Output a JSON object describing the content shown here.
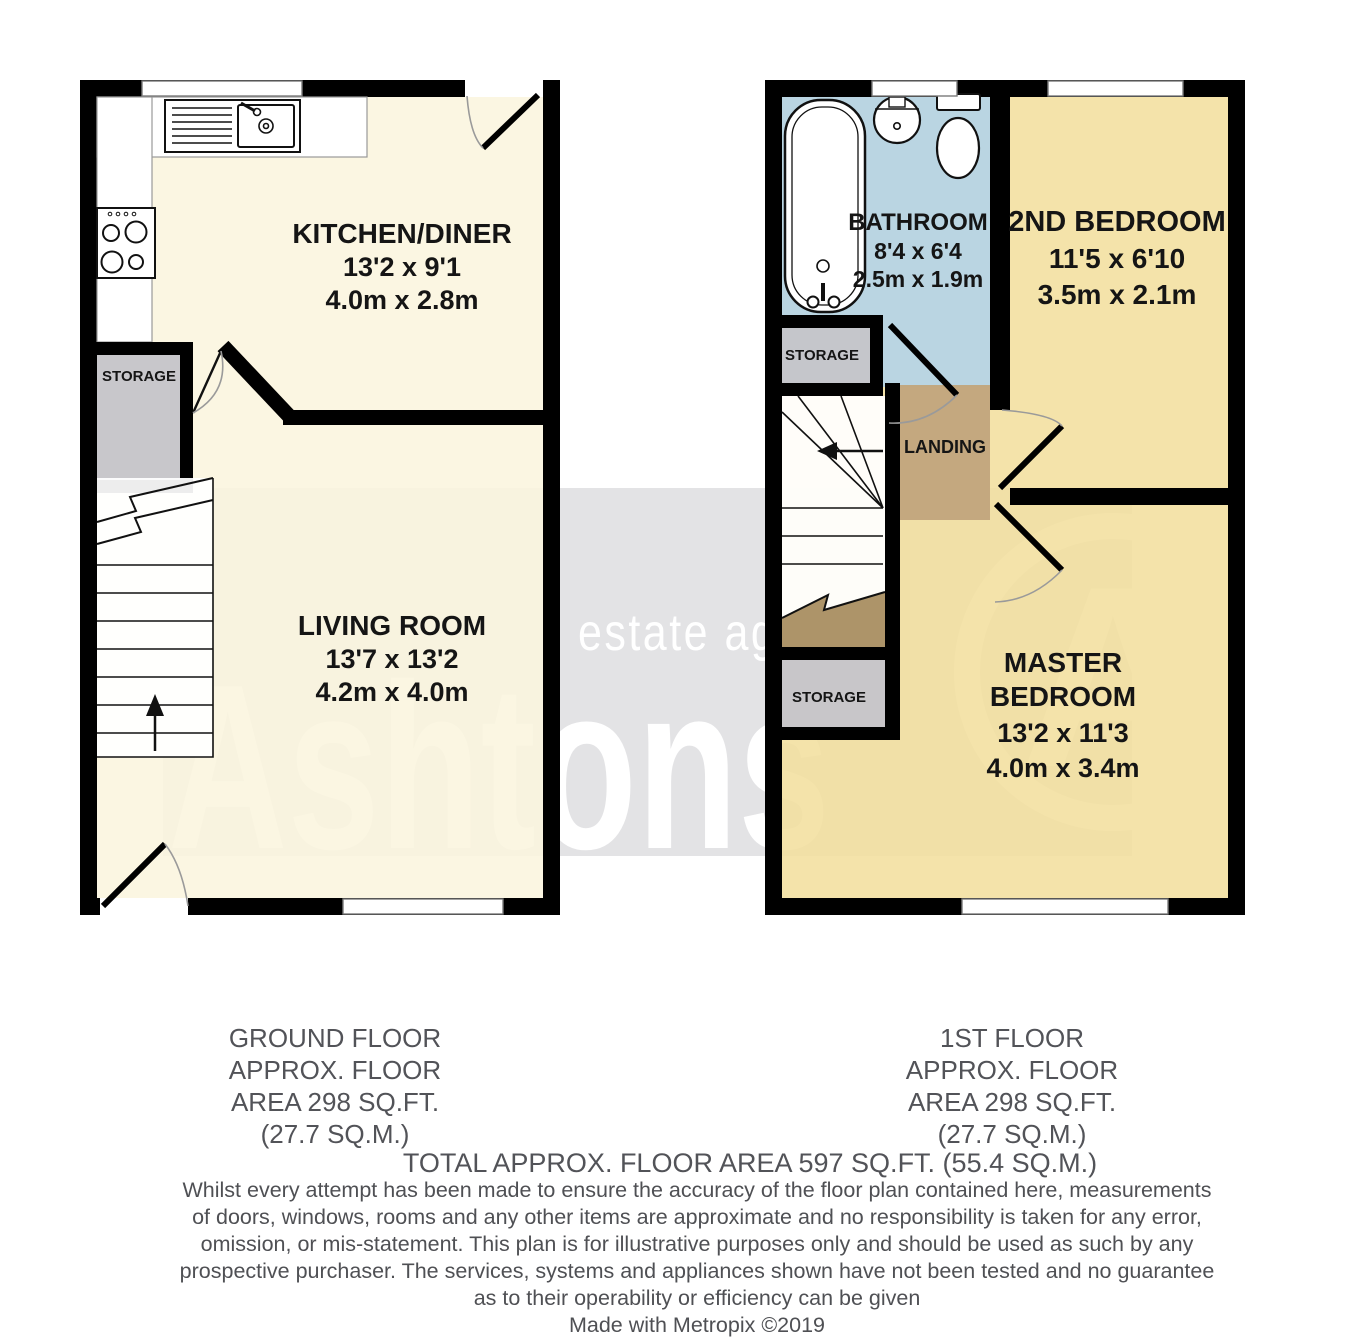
{
  "watermark": {
    "brand": "Ashtons",
    "tagline": "estate agency",
    "initial": "A"
  },
  "ground_floor": {
    "caption": [
      "GROUND FLOOR",
      "APPROX. FLOOR",
      "AREA 298 SQ.FT.",
      "(27.7 SQ.M.)"
    ],
    "kitchen": {
      "name": "KITCHEN/DINER",
      "size_imperial": "13'2 x 9'1",
      "size_metric": "4.0m x 2.8m"
    },
    "living_room": {
      "name": "LIVING ROOM",
      "size_imperial": "13'7 x 13'2",
      "size_metric": "4.2m x 4.0m"
    },
    "storage": {
      "name": "STORAGE"
    }
  },
  "first_floor": {
    "caption": [
      "1ST FLOOR",
      "APPROX. FLOOR",
      "AREA 298 SQ.FT.",
      "(27.7 SQ.M.)"
    ],
    "bathroom": {
      "name": "BATHROOM",
      "size_imperial": "8'4 x 6'4",
      "size_metric": "2.5m x 1.9m"
    },
    "second_bedroom": {
      "name": "2ND BEDROOM",
      "size_imperial": "11'5 x 6'10",
      "size_metric": "3.5m x 2.1m"
    },
    "master_bedroom": {
      "name_line1": "MASTER",
      "name_line2": "BEDROOM",
      "size_imperial": "13'2 x 11'3",
      "size_metric": "4.0m x 3.4m"
    },
    "landing": {
      "name": "LANDING"
    },
    "storage_upper": {
      "name": "STORAGE"
    },
    "storage_lower": {
      "name": "STORAGE"
    }
  },
  "summary": {
    "total": "TOTAL APPROX. FLOOR AREA 597 SQ.FT. (55.4 SQ.M.)"
  },
  "disclaimer": {
    "lines": [
      "Whilst every attempt has been made to ensure the accuracy of the floor plan contained here, measurements",
      "of doors, windows, rooms and any other items are approximate and no responsibility is taken for any error,",
      "omission, or mis-statement. This plan is for illustrative purposes only and should be used as such by any",
      "prospective purchaser. The services, systems and appliances shown have not been tested and no guarantee",
      "as to their operability or efficiency can be given"
    ],
    "credit": "Made with Metropix ©2019"
  },
  "colors": {
    "wall": "#000000",
    "ground_rooms": "#FAF5DE",
    "bedrooms": "#F3DF9E",
    "bathroom": "#B5D4E6",
    "landing": "#C2A67D",
    "stair_void": "#AA9166",
    "storage": "#C6C5CA",
    "watermark_band": "#E3E3E5",
    "footer_text": "#525358"
  }
}
